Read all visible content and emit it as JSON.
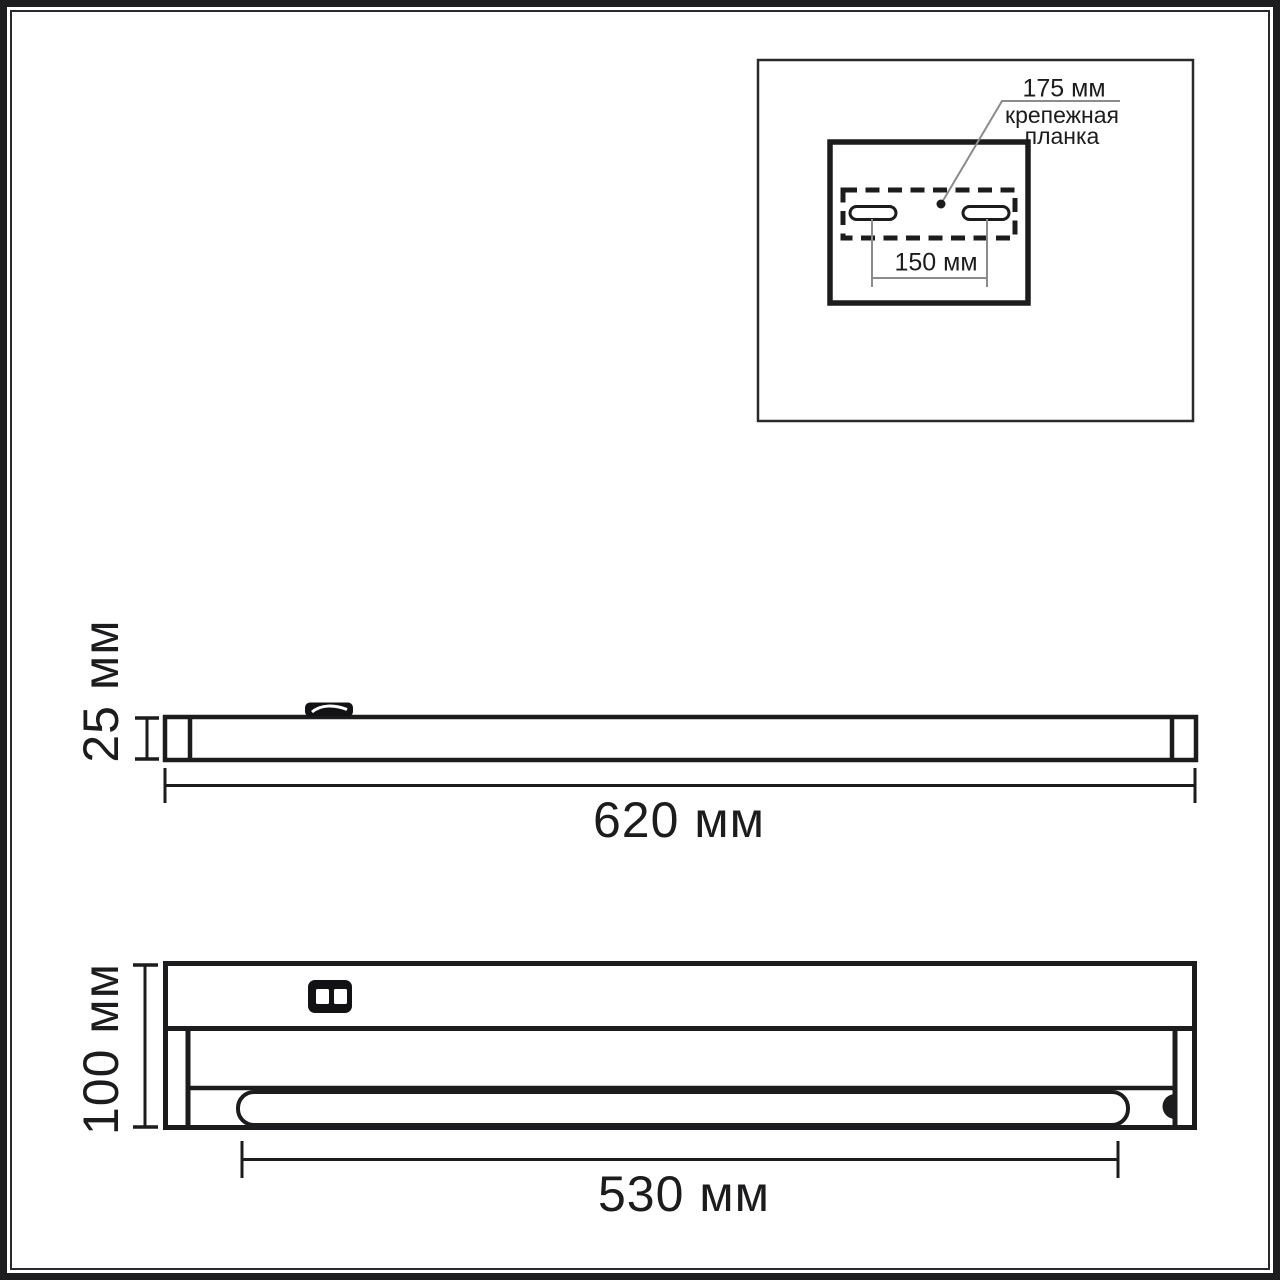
{
  "colors": {
    "line": "#1c1c1e",
    "leader": "#8b8b8b",
    "background": "#ffffff"
  },
  "inset": {
    "plate_width": "175 мм",
    "plate_name_line1": "крепежная",
    "plate_name_line2": "планка",
    "hole_spacing": "150 мм"
  },
  "side_view": {
    "height": "25 мм",
    "length": "620 мм"
  },
  "front_view": {
    "height": "100 мм",
    "lamp_length": "530 мм"
  }
}
